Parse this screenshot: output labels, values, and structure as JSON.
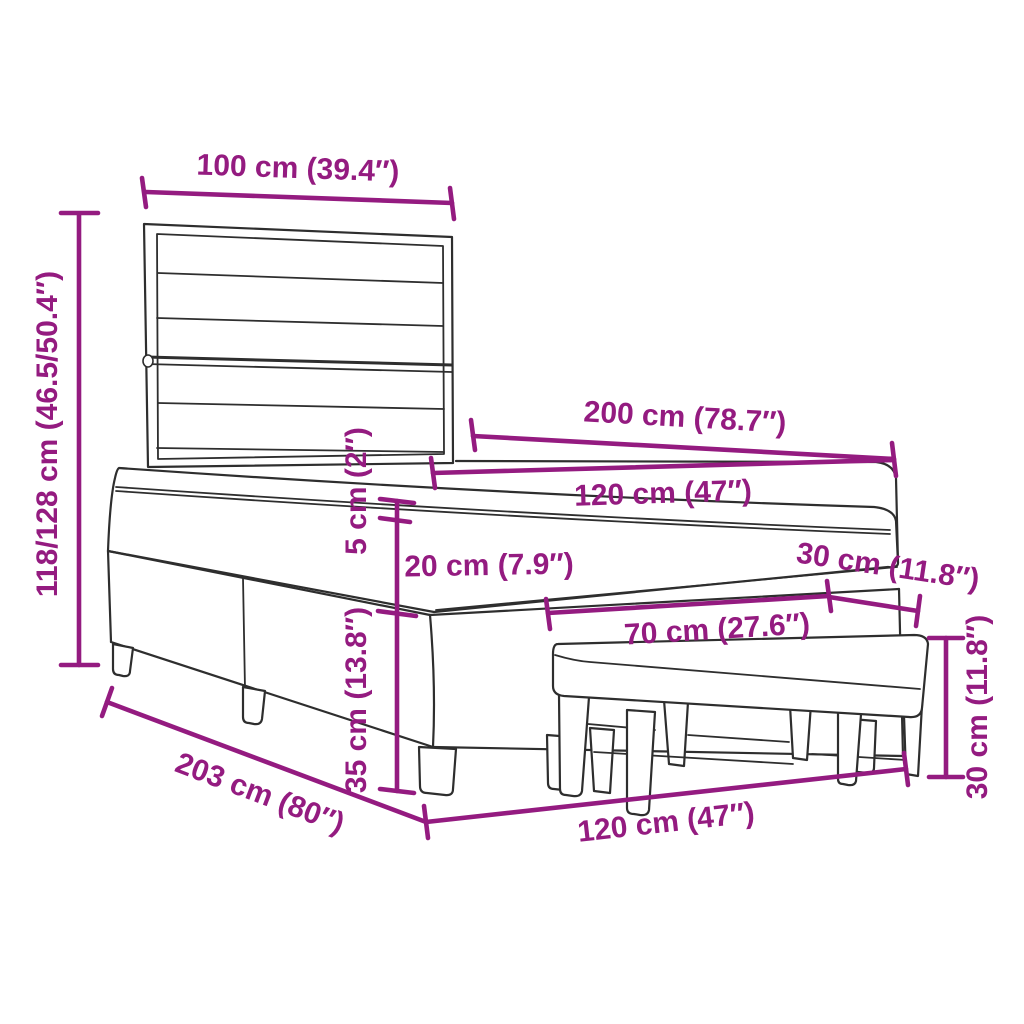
{
  "diagram": {
    "title": "Box spring bed with headboard and bench — dimension drawing",
    "colors": {
      "background": "#ffffff",
      "line_art": "#2e2e2e",
      "dimension": "#941b80"
    }
  },
  "dimensions": {
    "headboard_width": {
      "label": "100 cm (39.4″)"
    },
    "headboard_height": {
      "label": "118/128 cm (46.5/50.4″)"
    },
    "bed_length": {
      "label": "200 cm (78.7″)"
    },
    "mattress_width": {
      "label": "120 cm (47″)"
    },
    "topper_thickness": {
      "label": "5 cm (2″)"
    },
    "mattress_thickness": {
      "label": "20 cm (7.9″)"
    },
    "base_height": {
      "label": "35 cm (13.8″)"
    },
    "bench_depth": {
      "label": "30 cm (11.8″)"
    },
    "bench_length": {
      "label": "70 cm (27.6″)"
    },
    "bench_height": {
      "label": "30 cm (11.8″)"
    },
    "frame_length": {
      "label": "203 cm (80″)"
    },
    "frame_width": {
      "label": "120 cm (47″)"
    }
  }
}
